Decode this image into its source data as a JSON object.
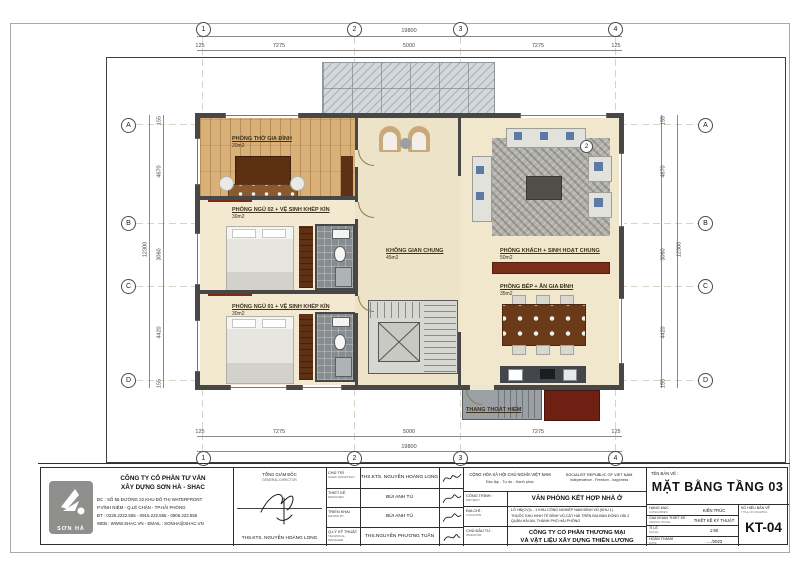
{
  "sheet": {
    "grid_cols": [
      "1",
      "2",
      "3",
      "4"
    ],
    "grid_rows": [
      "A",
      "B",
      "C",
      "D"
    ],
    "dims": {
      "h_overall": "19800",
      "h_segments": [
        "125",
        "7275",
        "5000",
        "7275",
        "125"
      ],
      "v_overall": "12300",
      "v_segments": [
        "155",
        "4670",
        "3060",
        "4420",
        "155"
      ]
    },
    "section_marker": "2"
  },
  "rooms": {
    "tho": {
      "name": "PHÒNG THỜ GIA ĐÌNH",
      "area": "20m2"
    },
    "ngu02": {
      "name": "PHÒNG NGỦ 02 + VỆ SINH KHÉP KÍN",
      "area": "30m2"
    },
    "ngu01": {
      "name": "PHÒNG NGỦ 01 + VỆ SINH KHÉP KÍN",
      "area": "30m2"
    },
    "chung": {
      "name": "KHÔNG GIAN CHUNG",
      "area": "45m2"
    },
    "khach": {
      "name": "PHÒNG KHÁCH + SINH HOẠT CHUNG",
      "area": "50m2"
    },
    "bep": {
      "name": "PHÒNG BẾP + ĂN GIA ĐÌNH",
      "area": "35m2"
    },
    "thang": {
      "name": "THANG THOÁT HIỂM"
    }
  },
  "colors": {
    "wood_floor": "#d9b078",
    "cream_floor": "#efe6cc",
    "wall": "#474747",
    "dark_wood": "#5e3114",
    "red_cabinet": "#7c2d18",
    "stair_gray": "#9aa0a4"
  },
  "titleblock": {
    "company": {
      "logo_text": "SƠN HÀ",
      "name_line1": "CÔNG TY CỔ PHẦN TƯ VẤN",
      "name_line2": "XÂY DỰNG SƠN HÀ - SHAC",
      "addr1": "ĐC : SỐ 55 ĐƯỜNG 22 KHU ĐÔ THỊ WATERFRONT",
      "addr2": "P.VĨNH NIỆM - Q.LÊ CHÂN - TP.HẢI PHÒNG",
      "addr3": "ĐT : 0225.2222.555 - 0916.222.555 - 0906.222.555",
      "addr4": "WEB : WWW.SHAC.VN - EMAIL : SONHA@SHAC.VN"
    },
    "director": {
      "label_vn": "TỔNG GIÁM ĐỐC",
      "label_en": "GENERAL DIRECTOR",
      "name": "THS.KTS. NGUYỄN HOÀNG LONG"
    },
    "roles": [
      {
        "label_vn": "CHỦ TRÌ",
        "label_en": "CHIEF ARCHITECT",
        "name": "THS.KTS. NGUYỄN HOÀNG LONG"
      },
      {
        "label_vn": "THIẾT KẾ",
        "label_en": "DESIGNER",
        "name": "BÙI ANH TÚ"
      },
      {
        "label_vn": "TRIỂN KHAI",
        "label_en": "DRAWN BY",
        "name": "BÙI ANH TÚ"
      },
      {
        "label_vn": "Q.LÝ KỸ THUẬT",
        "label_en": "TECHNICAL MANAGER",
        "name": "THS.NGUYỄN PHƯƠNG TUẤN"
      }
    ],
    "republic": {
      "vn1": "CỘNG HÒA XÃ HỘI CHỦ NGHĨA VIỆT NAM",
      "vn2": "Độc lập - Tự do - Hạnh phúc",
      "en1": "SOCIALIST REPUBLIC OF VIET NAM",
      "en2": "Independence - Freedom - happiness"
    },
    "project": {
      "label_vn": "CÔNG TRÌNH :",
      "label_en": "PROJECT",
      "value": "VĂN PHÒNG KẾT HỢP NHÀ Ở"
    },
    "location": {
      "label_vn": "ĐỊA CHỈ :",
      "label_en": "LOCATION",
      "line1": "LÔ HĐ(CV)1 - 1 KHU CÔNG NGHIỆP NAM ĐÌNH VŨ (KHU 1)",
      "line2": "THUỘC KHU KINH TẾ ĐÌNH VŨ-CÁT HẢI TRÊN ĐỊA BÀN ĐỒNG HẢI 2",
      "line3": "QUẬN HẢI AN, THÀNH PHỐ HẢI PHÒNG"
    },
    "investor": {
      "label_vn": "CHỦ ĐẦU TƯ :",
      "label_en": "INVESTOR",
      "line1": "CÔNG TY CỔ PHẦN THƯƠNG MẠI",
      "line2": "VÀ VẬT LIỆU XÂY DỰNG THIÊN LƯƠNG"
    },
    "drawing": {
      "header": "TÊN BẢN VẼ :",
      "title": "MẶT BẰNG TẦNG 03",
      "rows": [
        {
          "vn": "HẠNG MỤC",
          "en": "CATEGORIES",
          "value": "KIẾN TRÚC"
        },
        {
          "vn": "GIAI ĐOẠN THIẾT KẾ",
          "en": "DESIGN STAGE",
          "value": "THIẾT KẾ KỸ THUẬT"
        },
        {
          "vn": "TỈ LỆ",
          "en": "SCALE",
          "value": "1:90"
        },
        {
          "vn": "HOÀN THÀNH",
          "en": "DATE",
          "value": "...../2023"
        }
      ],
      "number_label_vn": "SỐ HIỆU BẢN VẼ",
      "number_label_en": "TITLE OF DRAWING",
      "number": "KT-04"
    }
  }
}
